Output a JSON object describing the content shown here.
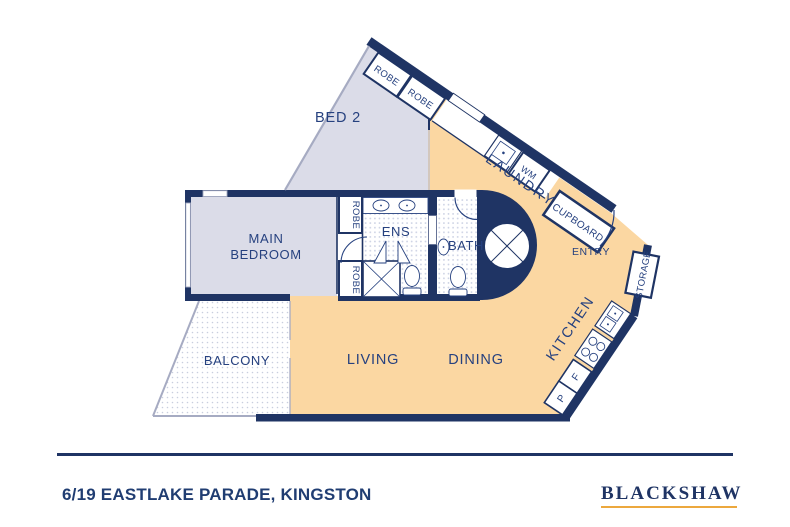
{
  "floorplan": {
    "rooms": {
      "bed2": "BED 2",
      "main_bedroom_line1": "MAIN",
      "main_bedroom_line2": "BEDROOM",
      "ens": "ENS",
      "bath": "BATH",
      "laundry": "LAUNDRY",
      "entry": "ENTRY",
      "kitchen": "KITCHEN",
      "living": "LIVING",
      "dining": "DINING",
      "balcony": "BALCONY"
    },
    "fixtures": {
      "robes": [
        "ROBE",
        "ROBE",
        "ROBE",
        "ROBE"
      ],
      "wm": "WM",
      "cupboard": "CUPBOARD",
      "storage": "STORAGE",
      "fridge": "F",
      "pantry": "P"
    },
    "colors": {
      "wall": "#1f3464",
      "open_floor": "#fbd7a2",
      "bedroom_floor": "#dbdce8",
      "label": "#26417f",
      "window_line": "#a6abc2",
      "gold": "#eca83d"
    }
  },
  "footer": {
    "address": "6/19 EASTLAKE PARADE, KINGSTON",
    "brand": "BLACKSHAW"
  }
}
